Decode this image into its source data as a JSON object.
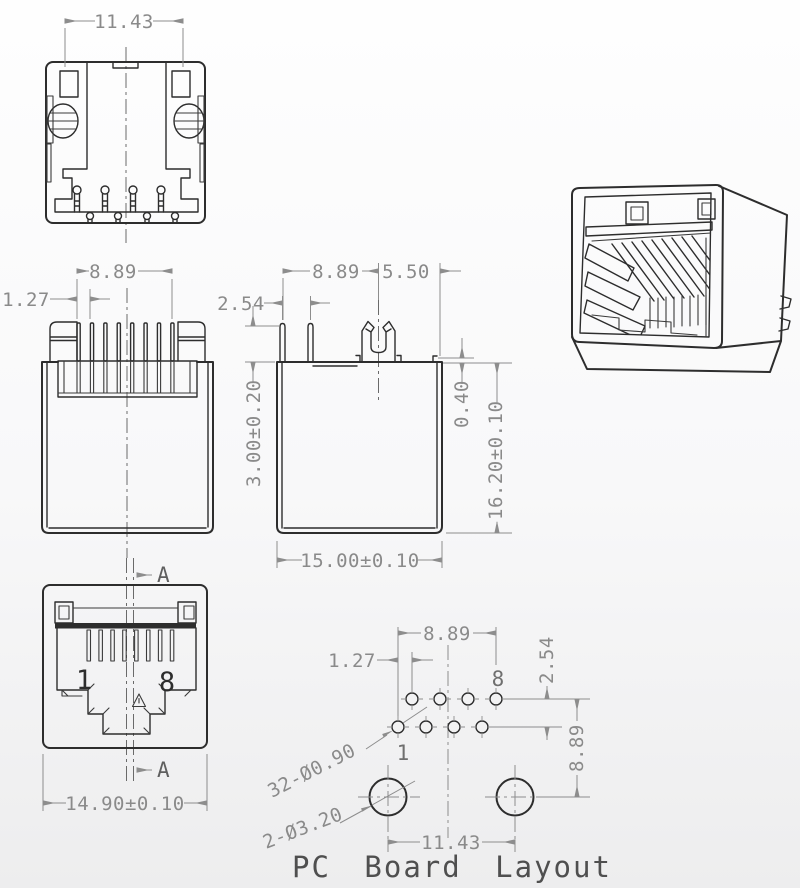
{
  "title": "PC Board Layout",
  "colors": {
    "part_line": "#2d2d2d",
    "dim_line": "#8d8d8d",
    "dim_text": "#8a8a8a",
    "title_text": "#4f4f4f",
    "background": "#f7f7f8"
  },
  "views": {
    "rear": {
      "width": "11.43"
    },
    "top": {
      "contact_span": "8.89",
      "contact_pitch": "1.27"
    },
    "side": {
      "contact_span": "8.89",
      "back_depth": "5.50",
      "pin_pitch": "2.54",
      "pin_length": "3.00±0.20",
      "lip": "0.40",
      "height": "16.20±0.10",
      "depth": "15.00±0.10"
    },
    "front": {
      "section_label": "A",
      "pin_first": "1",
      "pin_last": "8",
      "width": "14.90±0.10"
    },
    "pcb": {
      "row_span": "8.89",
      "row_offset": "1.27",
      "row_gap": "2.54",
      "mount_drop": "8.89",
      "contact_holes": "32-Ø0.90",
      "mount_holes": "2-Ø3.20",
      "mount_span": "11.43",
      "pin_first": "1",
      "pin_last": "8"
    }
  }
}
